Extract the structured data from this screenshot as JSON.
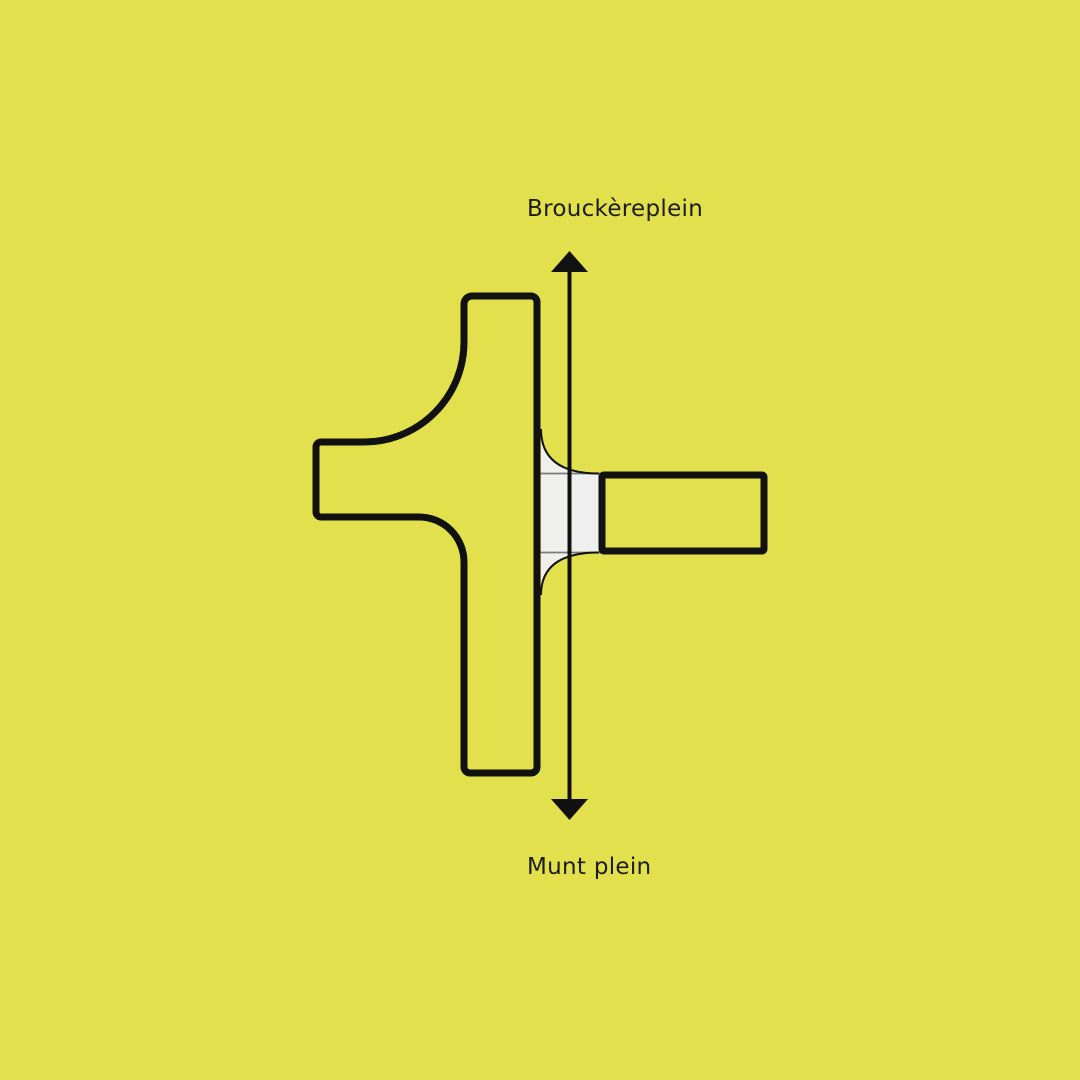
{
  "labels": {
    "top": "Brouckèreplein",
    "bottom": "Munt plein"
  },
  "colors": {
    "background": "#e2e14d",
    "outline": "#111111",
    "crossing_fill": "#efefed",
    "crossing_line": "#7a7a7a",
    "text": "#1c1c1c"
  },
  "icons": {
    "arrow_up": "arrowhead-up-icon",
    "arrow_down": "arrowhead-down-icon"
  }
}
